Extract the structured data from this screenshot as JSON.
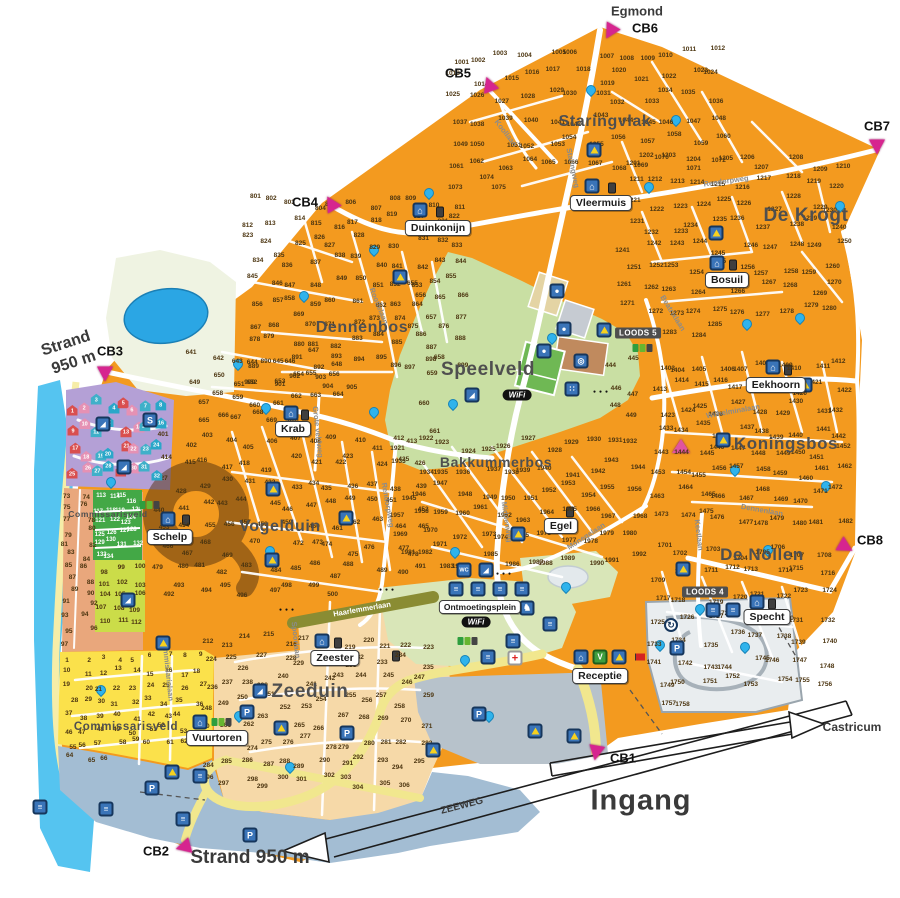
{
  "map": {
    "wifi_label": "WiFi",
    "captions": [
      {
        "text": "Egmond",
        "x": 637,
        "y": 11,
        "size": 13,
        "w": 700
      },
      {
        "text": "Ingang",
        "x": 641,
        "y": 801,
        "size": 29,
        "w": 600,
        "ls": 1
      },
      {
        "text": "Castricum",
        "x": 852,
        "y": 727,
        "size": 12,
        "w": 600
      },
      {
        "text": "Strand",
        "x": 66,
        "y": 344,
        "size": 16,
        "w": 700,
        "rot": -18
      },
      {
        "text": "950 m",
        "x": 74,
        "y": 363,
        "size": 16,
        "w": 700,
        "rot": -18
      },
      {
        "text": "Strand 950 m",
        "x": 250,
        "y": 858,
        "size": 19,
        "w": 600
      },
      {
        "text": "ZEEWEG",
        "x": 462,
        "y": 806,
        "size": 10,
        "w": 600,
        "rot": -14.5
      }
    ],
    "area_labels": [
      {
        "text": "Staringvlak",
        "x": 605,
        "y": 122,
        "size": 16
      },
      {
        "text": "De Krogt",
        "x": 806,
        "y": 216,
        "size": 19
      },
      {
        "text": "Dennenbos",
        "x": 362,
        "y": 328,
        "size": 16
      },
      {
        "text": "Speelveld",
        "x": 488,
        "y": 370,
        "size": 19
      },
      {
        "text": "Bakkummerbos",
        "x": 496,
        "y": 462,
        "size": 14
      },
      {
        "text": "Koningsbos",
        "x": 786,
        "y": 444,
        "size": 17
      },
      {
        "text": "De Nollen",
        "x": 762,
        "y": 555,
        "size": 17
      },
      {
        "text": "Vogelduin",
        "x": 280,
        "y": 527,
        "size": 16
      },
      {
        "text": "Zeeduin",
        "x": 310,
        "y": 692,
        "size": 19
      },
      {
        "text": "Commissarisveld",
        "x": 108,
        "y": 514,
        "size": 8.5
      },
      {
        "text": "Commissarisveld",
        "x": 126,
        "y": 727,
        "size": 11.5
      }
    ],
    "road_labels": [
      {
        "text": "Koollaan",
        "x": 506,
        "y": 133,
        "rot": 52
      },
      {
        "text": "Staringweg",
        "x": 573,
        "y": 168,
        "rot": 78
      },
      {
        "text": "Rendorpweg",
        "x": 726,
        "y": 181,
        "rot": -8
      },
      {
        "text": "Rendorpweg",
        "x": 388,
        "y": 505,
        "rot": 80
      },
      {
        "text": "Beatrixlaan",
        "x": 673,
        "y": 313,
        "rot": 58
      },
      {
        "text": "Wilhelminalaan",
        "x": 733,
        "y": 411,
        "rot": -10
      },
      {
        "text": "Dennenlaan",
        "x": 762,
        "y": 510,
        "rot": 10
      },
      {
        "text": "Keetlaan",
        "x": 699,
        "y": 535,
        "rot": 83
      },
      {
        "text": "Monegelaan",
        "x": 586,
        "y": 536,
        "rot": -33
      },
      {
        "text": "Middenweg",
        "x": 507,
        "y": 522,
        "rot": 82
      },
      {
        "text": "Grote veldweg",
        "x": 318,
        "y": 432,
        "rot": 84
      },
      {
        "text": "Roottelaan",
        "x": 379,
        "y": 306,
        "rot": 68
      },
      {
        "text": "Haarlemmerlaan",
        "x": 362,
        "y": 609,
        "rot": -10,
        "color": "#ffffff"
      },
      {
        "text": "Spoorlaan",
        "x": 296,
        "y": 640,
        "rot": 84
      },
      {
        "text": "Commissarislaan",
        "x": 168,
        "y": 670,
        "rot": 84
      }
    ],
    "cb_markers": [
      {
        "label": "CB1",
        "tx": 596,
        "ty": 753,
        "lx": 623,
        "ly": 758,
        "rot": 10
      },
      {
        "label": "CB2",
        "tx": 183,
        "ty": 847,
        "lx": 156,
        "ly": 851,
        "rot": 75
      },
      {
        "label": "CB3",
        "tx": 105,
        "ty": 374,
        "lx": 110,
        "ly": 351,
        "rot": 0
      },
      {
        "label": "CB4",
        "tx": 331,
        "ty": 203,
        "lx": 305,
        "ly": 202,
        "rot": 150
      },
      {
        "label": "CB5",
        "tx": 489,
        "ty": 84,
        "lx": 458,
        "ly": 73,
        "rot": 160
      },
      {
        "label": "CB6",
        "tx": 610,
        "ty": 32,
        "lx": 645,
        "ly": 28,
        "rot": 30
      },
      {
        "label": "CB7",
        "tx": 877,
        "ty": 147,
        "lx": 877,
        "ly": 126,
        "rot": 0
      },
      {
        "label": "CB8",
        "tx": 846,
        "ty": 547,
        "lx": 870,
        "ly": 540,
        "rot": -60
      }
    ],
    "facility_badges": [
      {
        "text": "Vleermuis",
        "x": 601,
        "y": 203
      },
      {
        "text": "Duinkonijn",
        "x": 438,
        "y": 228
      },
      {
        "text": "Bosuil",
        "x": 727,
        "y": 280
      },
      {
        "text": "Eekhoorn",
        "x": 776,
        "y": 385
      },
      {
        "text": "Krab",
        "x": 293,
        "y": 429
      },
      {
        "text": "Schelp",
        "x": 170,
        "y": 537
      },
      {
        "text": "Egel",
        "x": 561,
        "y": 526
      },
      {
        "text": "Specht",
        "x": 767,
        "y": 617
      },
      {
        "text": "Zeester",
        "x": 335,
        "y": 658
      },
      {
        "text": "Vuurtoren",
        "x": 217,
        "y": 738
      },
      {
        "text": "Receptie",
        "x": 600,
        "y": 676
      },
      {
        "text": "Ontmoetingsplein",
        "x": 480,
        "y": 607,
        "small": true
      }
    ],
    "loods_badges": [
      {
        "text": "LOODS 5",
        "x": 638,
        "y": 333
      },
      {
        "text": "LOODS 4",
        "x": 705,
        "y": 592
      }
    ],
    "pitch_regions": [
      {
        "name": "staringvlak",
        "x0": 448,
        "y0": 45,
        "x1": 728,
        "y1": 195,
        "start": 1001,
        "count": 75,
        "seed": 1
      },
      {
        "name": "de-krogt",
        "x0": 618,
        "y0": 152,
        "x1": 848,
        "y1": 342,
        "start": 1201,
        "count": 85,
        "seed": 2
      },
      {
        "name": "dennenbos",
        "x0": 242,
        "y0": 192,
        "x1": 468,
        "y1": 392,
        "start": 801,
        "count": 105,
        "seed": 3
      },
      {
        "name": "koningsbos",
        "x0": 652,
        "y0": 355,
        "x1": 850,
        "y1": 528,
        "start": 1403,
        "count": 80,
        "seed": 4
      },
      {
        "name": "de-nollen",
        "x0": 650,
        "y0": 542,
        "x1": 838,
        "y1": 715,
        "start": 1701,
        "count": 58,
        "seed": 5
      },
      {
        "name": "vogelduin",
        "x0": 152,
        "y0": 432,
        "x1": 430,
        "y1": 602,
        "start": 401,
        "count": 100,
        "seed": 6
      },
      {
        "name": "vogelduin-noord",
        "x0": 188,
        "y0": 348,
        "x1": 342,
        "y1": 430,
        "start": 641,
        "count": 30,
        "seed": 7
      },
      {
        "name": "bakkummerbos",
        "x0": 392,
        "y0": 435,
        "x1": 645,
        "y1": 572,
        "start": 1921,
        "count": 72,
        "seed": 8
      },
      {
        "name": "speelveld-rand",
        "x0": 398,
        "y0": 262,
        "x1": 448,
        "y1": 440,
        "start": 655,
        "count": 7,
        "seed": 9
      },
      {
        "name": "loods5-rand",
        "x0": 598,
        "y0": 350,
        "x1": 648,
        "y1": 425,
        "start": 444,
        "count": 6,
        "seed": 10
      },
      {
        "name": "zeeduin",
        "x0": 198,
        "y0": 632,
        "x1": 432,
        "y1": 792,
        "start": 212,
        "count": 95,
        "seed": 11
      },
      {
        "name": "commissarisveld-noord",
        "x0": 60,
        "y0": 490,
        "x1": 98,
        "y1": 648,
        "start": 73,
        "count": 25,
        "seed": 12
      },
      {
        "name": "huurstroken",
        "x0": 95,
        "y0": 492,
        "x1": 140,
        "y1": 560,
        "start": 113,
        "count": 22,
        "seed": 13,
        "color": "#ffffff",
        "fs": 6
      },
      {
        "name": "groenveld",
        "x0": 97,
        "y0": 563,
        "x1": 143,
        "y1": 630,
        "start": 98,
        "count": 15,
        "seed": 14
      },
      {
        "name": "commissarisveld-zuid",
        "x0": 62,
        "y0": 652,
        "x1": 206,
        "y1": 766,
        "start": 1,
        "count": 66,
        "seed": 15
      }
    ],
    "beach_houses": {
      "x0": 68,
      "y0": 394,
      "x1": 166,
      "y1": 484,
      "count": 32,
      "start": 1,
      "colors": [
        "#d94f4f",
        "#e591b4",
        "#3fb0c9",
        "#2aa7c9"
      ]
    },
    "icons": [
      [
        "tent",
        594,
        150
      ],
      [
        "tent",
        716,
        233
      ],
      [
        "tent",
        400,
        277
      ],
      [
        "tent",
        604,
        330
      ],
      [
        "tent",
        273,
        489
      ],
      [
        "tent",
        723,
        440
      ],
      [
        "tent",
        805,
        385
      ],
      [
        "tent",
        518,
        534
      ],
      [
        "tent",
        272,
        560
      ],
      [
        "tent",
        683,
        569
      ],
      [
        "tent",
        163,
        643
      ],
      [
        "tent",
        281,
        728
      ],
      [
        "tent",
        535,
        731
      ],
      [
        "tent",
        574,
        736
      ],
      [
        "tent",
        433,
        750
      ],
      [
        "tent",
        172,
        772
      ],
      [
        "tent",
        346,
        518
      ],
      [
        "tent",
        619,
        657
      ],
      [
        "san",
        592,
        186
      ],
      [
        "san",
        420,
        210
      ],
      [
        "san",
        717,
        263
      ],
      [
        "san",
        773,
        367
      ],
      [
        "san",
        291,
        413
      ],
      [
        "san",
        168,
        519
      ],
      [
        "san",
        322,
        641
      ],
      [
        "san",
        200,
        722
      ],
      [
        "san",
        757,
        602
      ],
      [
        "wc",
        464,
        570
      ],
      [
        "slide",
        486,
        570
      ],
      [
        "slide",
        103,
        424
      ],
      [
        "slide",
        124,
        467
      ],
      [
        "slide",
        260,
        691
      ],
      [
        "slide",
        128,
        600
      ],
      [
        "bin",
        612,
        188
      ],
      [
        "bin",
        440,
        212
      ],
      [
        "bin",
        733,
        265
      ],
      [
        "bin",
        788,
        370
      ],
      [
        "bin",
        305,
        415
      ],
      [
        "bin",
        186,
        520
      ],
      [
        "bin",
        338,
        643
      ],
      [
        "bin",
        570,
        512
      ],
      [
        "bin",
        772,
        604
      ],
      [
        "bin",
        396,
        656
      ],
      [
        "greenbins",
        468,
        641
      ],
      [
        "greenbins",
        150,
        505
      ],
      [
        "greenbins",
        222,
        722
      ],
      [
        "greenbins",
        643,
        348
      ],
      [
        "p",
        152,
        788
      ],
      [
        "p",
        247,
        712
      ],
      [
        "p",
        250,
        835
      ],
      [
        "p",
        479,
        714
      ],
      [
        "p",
        677,
        648
      ],
      [
        "p",
        347,
        733
      ],
      [
        "s",
        150,
        420
      ],
      [
        "horse",
        527,
        608
      ],
      [
        "gen",
        456,
        589
      ],
      [
        "gen",
        478,
        589
      ],
      [
        "gen",
        500,
        589
      ],
      [
        "gen",
        522,
        589
      ],
      [
        "gen",
        550,
        624
      ],
      [
        "gen",
        513,
        641
      ],
      [
        "gen",
        488,
        657
      ],
      [
        "gen",
        713,
        610
      ],
      [
        "gen",
        733,
        610
      ],
      [
        "gen",
        106,
        809
      ],
      [
        "gen",
        40,
        807
      ],
      [
        "gen",
        183,
        819
      ],
      [
        "gen",
        200,
        776
      ],
      [
        "round",
        671,
        625
      ],
      [
        "firstaid",
        515,
        658
      ],
      [
        "house",
        581,
        657
      ],
      [
        "v",
        600,
        657
      ],
      [
        "flag",
        640,
        657
      ],
      [
        "pinktent",
        681,
        446
      ],
      [
        "ball",
        557,
        291
      ],
      [
        "ball",
        564,
        329
      ],
      [
        "ball",
        544,
        351
      ],
      [
        "dart",
        581,
        361
      ],
      [
        "dice",
        572,
        389
      ],
      [
        "slide",
        472,
        395
      ],
      [
        "wifi",
        517,
        395
      ],
      [
        "wifi",
        476,
        622
      ],
      [
        "dots",
        505,
        574
      ],
      [
        "dots",
        602,
        392
      ],
      [
        "dots",
        288,
        610
      ],
      [
        "dots",
        388,
        590
      ],
      [
        "tap",
        591,
        90
      ],
      [
        "tap",
        676,
        120
      ],
      [
        "tap",
        649,
        187
      ],
      [
        "tap",
        840,
        206
      ],
      [
        "tap",
        429,
        193
      ],
      [
        "tap",
        374,
        250
      ],
      [
        "tap",
        304,
        296
      ],
      [
        "tap",
        552,
        338
      ],
      [
        "tap",
        747,
        324
      ],
      [
        "tap",
        800,
        318
      ],
      [
        "tap",
        238,
        364
      ],
      [
        "tap",
        266,
        408
      ],
      [
        "tap",
        374,
        412
      ],
      [
        "tap",
        453,
        404
      ],
      [
        "tap",
        735,
        470
      ],
      [
        "tap",
        826,
        486
      ],
      [
        "tap",
        270,
        551
      ],
      [
        "tap",
        455,
        552
      ],
      [
        "tap",
        768,
        550
      ],
      [
        "tap",
        566,
        587
      ],
      [
        "tap",
        660,
        645
      ],
      [
        "tap",
        745,
        647
      ],
      [
        "tap",
        465,
        660
      ],
      [
        "tap",
        239,
        716
      ],
      [
        "tap",
        290,
        767
      ],
      [
        "tap",
        101,
        690
      ],
      [
        "tap",
        111,
        482
      ],
      [
        "tap",
        489,
        716
      ],
      [
        "tap",
        700,
        609
      ]
    ]
  }
}
